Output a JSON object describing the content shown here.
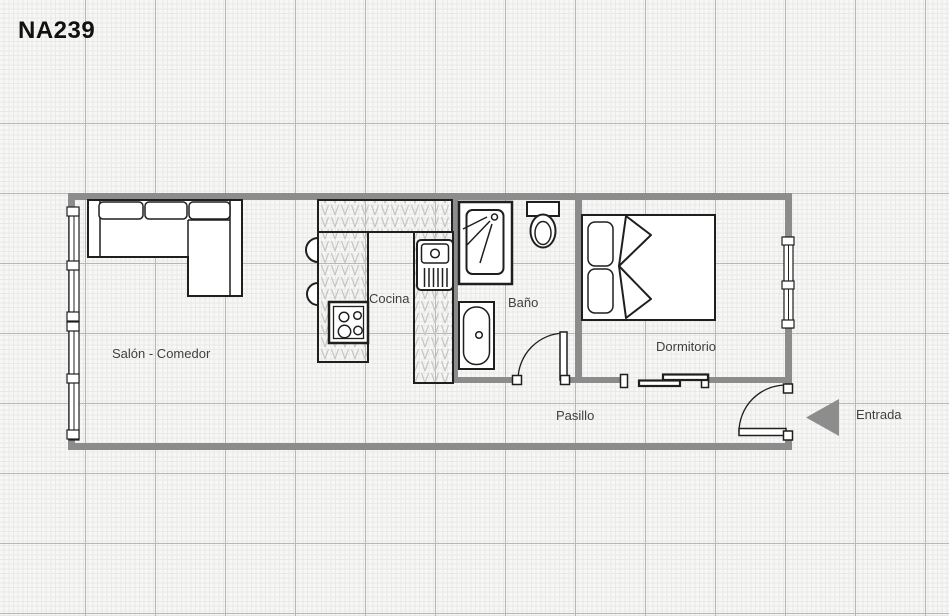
{
  "title": "NA239",
  "rooms": {
    "salon": "Salón - Comedor",
    "cocina": "Cocina",
    "bano": "Baño",
    "dormitorio": "Dormitorio",
    "pasillo": "Pasillo"
  },
  "entrance": {
    "label": "Entrada",
    "arrow_icon": "left-pointing-triangle"
  },
  "colors": {
    "wall": "#8c8c8c",
    "entrance_arrow": "#8d8d8d",
    "furniture_stroke": "#1f1f1f",
    "counter_hatch": "#c6c6c4",
    "label_text": "#3f3f3f",
    "paper": "#f7f7f5",
    "grid_minor": "#e9e9e7",
    "grid_major": "#b7b7b5"
  }
}
